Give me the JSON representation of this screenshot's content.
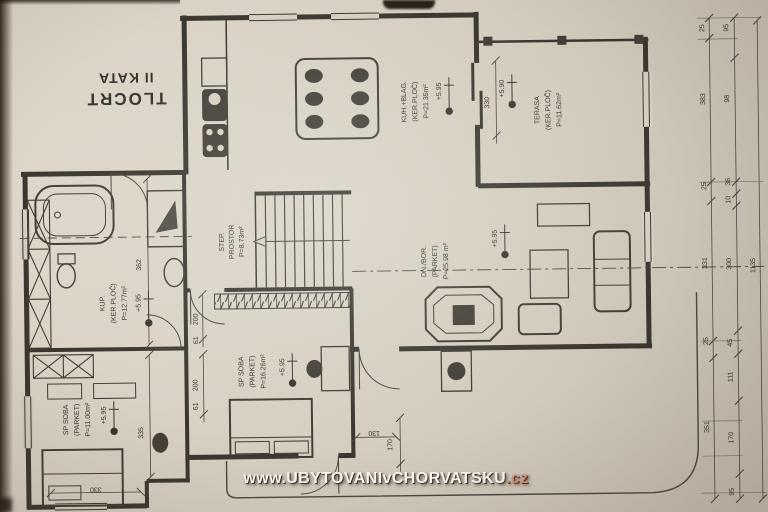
{
  "title": {
    "line1": "TLOCRT",
    "line2": "II KATA"
  },
  "watermark": {
    "prefix": "www.",
    "main": "UBYTOVANIvCHORVATSKU",
    "suffix": ".cz"
  },
  "rooms": {
    "kup": {
      "name": "KUP.",
      "finish": "(KER.PLOČ)",
      "area": "P=12.77m²",
      "elev": "+5.95"
    },
    "soba1": {
      "name": "SP SOBA",
      "finish": "(PARKET)",
      "area": "P=11.00m²",
      "elev": "+5.95"
    },
    "soba2": {
      "name": "SP SOBA",
      "finish": "(PARKET)",
      "area": "P=16.26m²",
      "elev": "+5.95"
    },
    "step": {
      "name": "STEP.",
      "finish": "PROSTOR",
      "area": "P=8.73m²"
    },
    "dnbor": {
      "name": "DN./BOR.",
      "finish": "(PARKET)",
      "area": "P=25.98 m²",
      "elev": "+5.95"
    },
    "kuh": {
      "name": "KUH.+BLAG.",
      "finish": "(KER.PLOČ)",
      "area": "P=21.35m²",
      "elev": "+5.95"
    },
    "terasa": {
      "name": "TERASA",
      "finish": "(KER.PLOČ)",
      "area": "P=11.62m²",
      "elev": "+5.90"
    }
  },
  "dims": {
    "right_outer": [
      "25",
      "383",
      "25",
      "331",
      "25",
      "351"
    ],
    "right_inner": [
      "95",
      "98",
      "36",
      "10",
      "300",
      "45",
      "111",
      "170",
      "95"
    ],
    "total": "1135",
    "interior": {
      "d362": "362",
      "d335": "335",
      "d330a": "330",
      "d330b": "330",
      "d200a": "200",
      "d61a": "61",
      "d200b": "200",
      "d61b": "61",
      "d130": "130",
      "d170": "170"
    }
  }
}
